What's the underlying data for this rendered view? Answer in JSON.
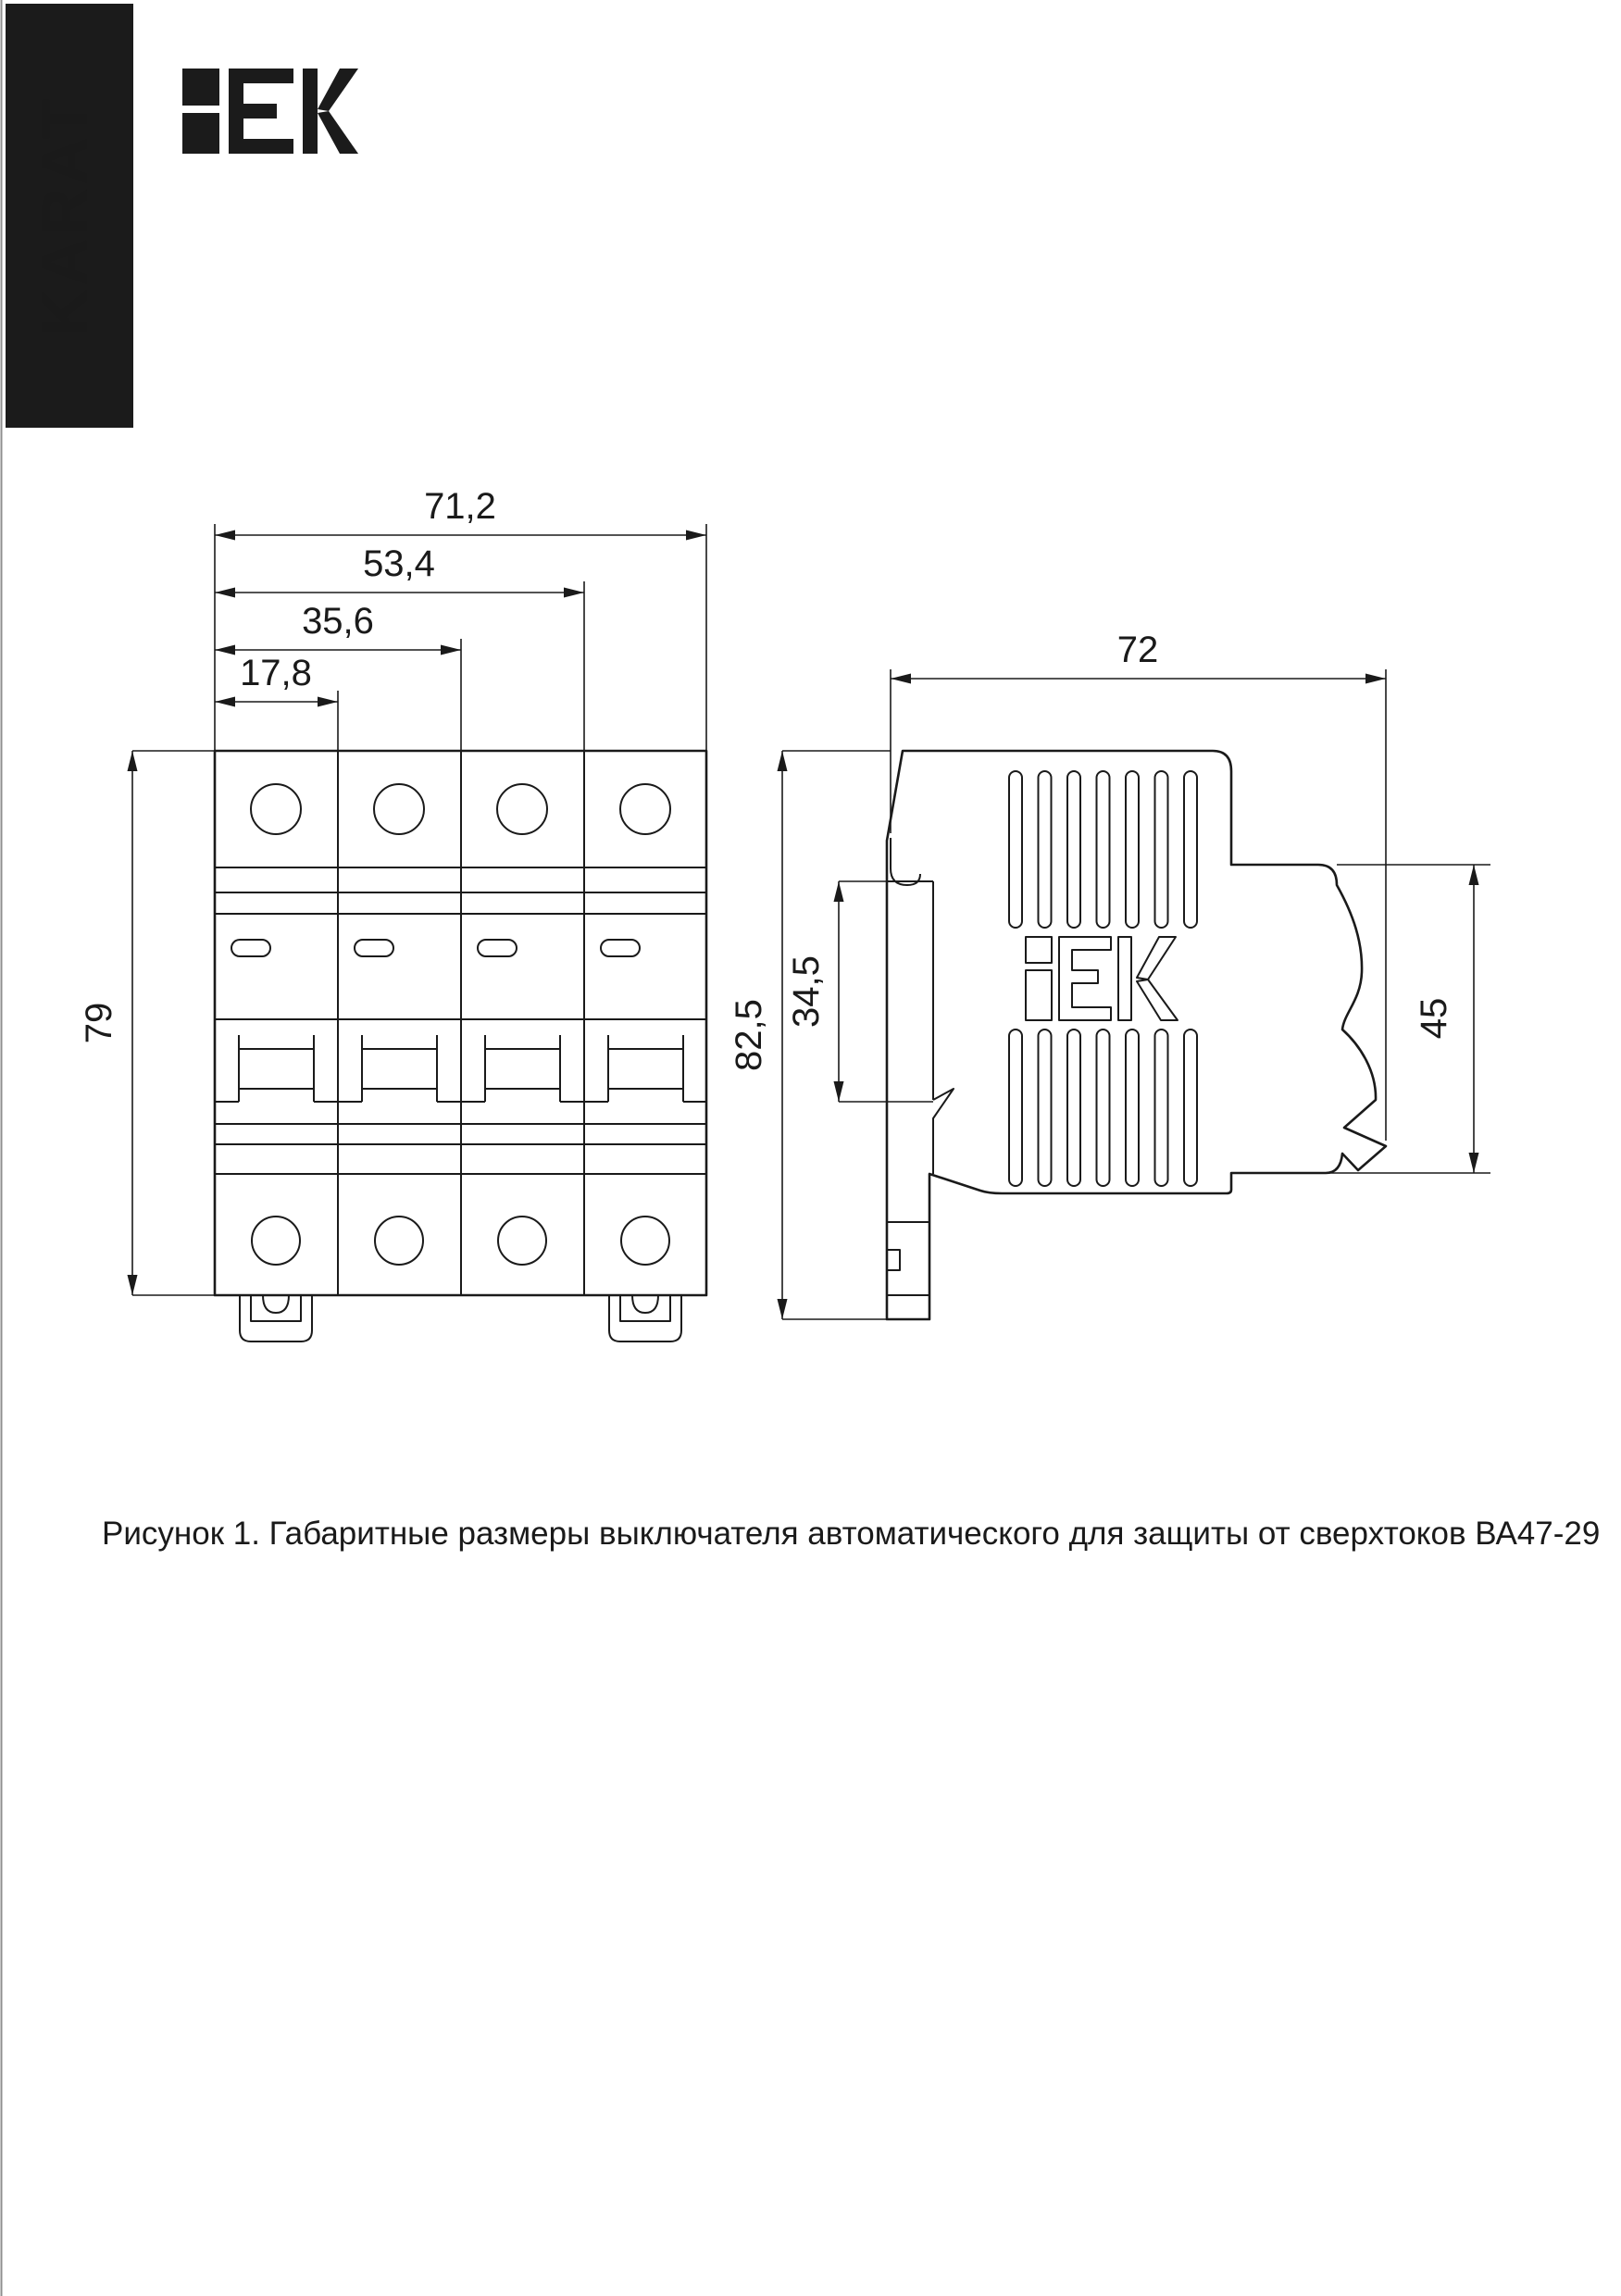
{
  "page": {
    "background": "#ffffff",
    "edge_line_color": "#8f8f8f"
  },
  "banner": {
    "text": "KARAT",
    "bg_color": "#1b1b1b",
    "text_color": "#ffffff"
  },
  "logo": {
    "text": "IEK"
  },
  "figure": {
    "caption": "Рисунок 1. Габаритные размеры выключателя автоматического для защиты от сверхтоков ВА47-29",
    "product": "ВА47-29",
    "front_view": {
      "modules": 4,
      "width_dims": [
        "71,2",
        "53,4",
        "35,6",
        "17,8"
      ],
      "height_dim": "79"
    },
    "side_view": {
      "width_dim": "72",
      "overall_height_dim": "82,5",
      "din_plate_dim": "34,5",
      "terminal_height_dim": "45",
      "logo_text": "IEK"
    }
  }
}
